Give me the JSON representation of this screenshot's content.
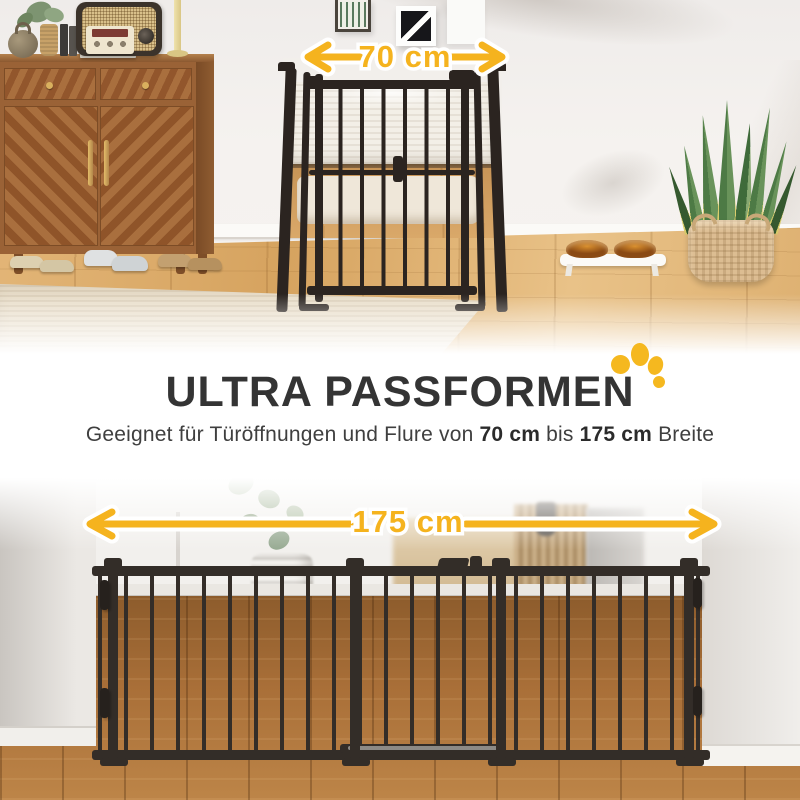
{
  "top_photo": {
    "dimension_label": "70 cm"
  },
  "headline": {
    "title": "ULTRA PASSFORMEN"
  },
  "subtitle": {
    "part1": "Geeignet für Türöffnungen und Flure von ",
    "bold1": "70 cm",
    "part2": " bis ",
    "bold2": "175 cm",
    "part3": " Breite"
  },
  "bottom_photo": {
    "dimension_label": "175 cm"
  },
  "colors": {
    "accent_yellow": "#F5B31E",
    "headline_dark": "#343434",
    "gate_dark": "#2B2420",
    "paw_yellow": "#F5B81F"
  },
  "icons": {
    "paw": "paw-print-icon",
    "arrow_left": "arrow-left-icon",
    "arrow_right": "arrow-right-icon"
  }
}
